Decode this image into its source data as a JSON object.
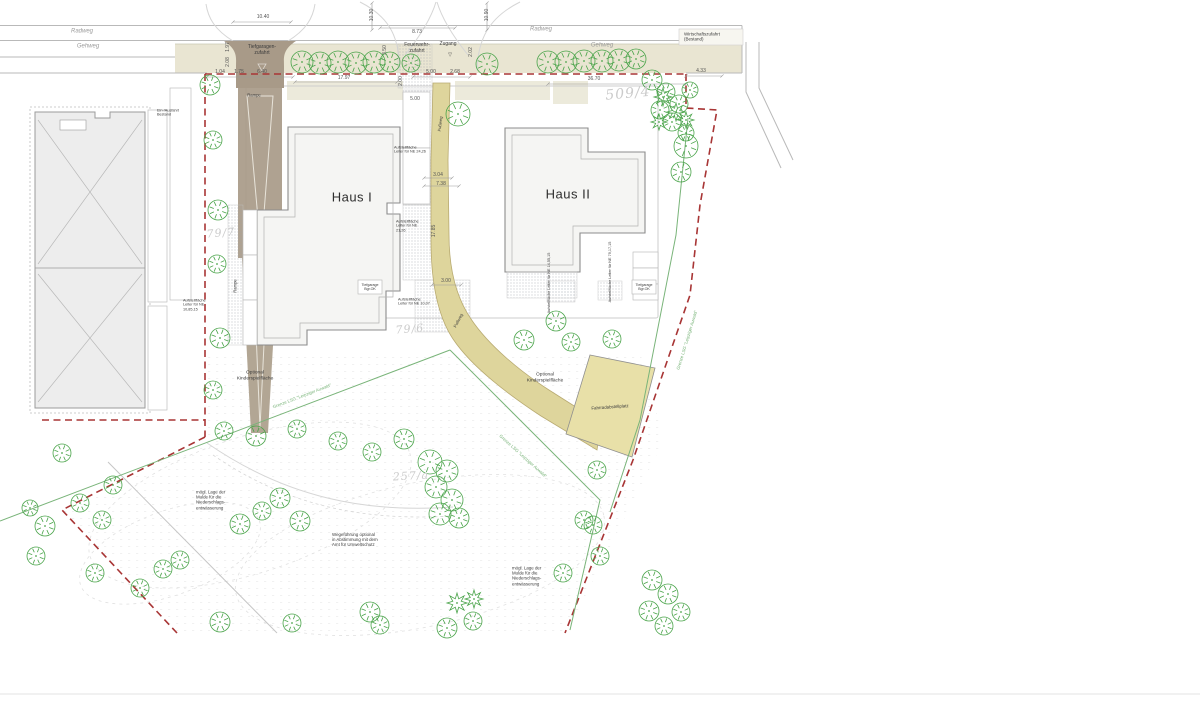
{
  "title": "Lageplan Haus I / Haus II",
  "colors": {
    "boundary": "#a83535",
    "lsg": "#79b479",
    "tree": "#4aa44a",
    "band": "#e9e5d2",
    "ramp": "#a89a88",
    "ramp2": "#b2a694",
    "path": "#ded59c",
    "bike": "#e8e0a8",
    "bld": "#f5f5f3",
    "ex": "#ededed"
  },
  "labels": [
    {
      "t": "Radweg",
      "x": 82,
      "y": 32,
      "s": 6,
      "c": "road",
      "n": "radweg-label-left"
    },
    {
      "t": "Gehweg",
      "x": 88,
      "y": 47,
      "s": 6,
      "c": "road",
      "n": "gehweg-label-left"
    },
    {
      "t": "Radweg",
      "x": 541,
      "y": 30,
      "s": 6,
      "c": "road",
      "n": "radweg-label-right"
    },
    {
      "t": "Gehweg",
      "x": 602,
      "y": 46,
      "s": 6,
      "c": "road",
      "n": "gehweg-label-right"
    },
    {
      "t": "Wirtschaftszufahrt\n(Bestand)",
      "x": 684,
      "y": 37,
      "s": 4.5,
      "a": "l",
      "n": "wirtschaftszufahrt-label"
    },
    {
      "t": "Tiefgaragen-\nzufahrt",
      "x": 262,
      "y": 51,
      "s": 5,
      "n": "tiefgaragenzufahrt-label"
    },
    {
      "t": "Feuerwehr-\nzufahrt",
      "x": 417,
      "y": 49,
      "s": 5,
      "n": "feuerwehrzufahrt-label"
    },
    {
      "t": "Zugang",
      "x": 448,
      "y": 45,
      "s": 5,
      "n": "zugang-label"
    },
    {
      "t": "▽",
      "x": 450,
      "y": 56,
      "s": 5,
      "n": "zugang-arrow"
    },
    {
      "t": "Rampe",
      "x": 254,
      "y": 96,
      "s": 4.2,
      "n": "rampe-label"
    },
    {
      "t": "Rampe",
      "x": 236,
      "y": 286,
      "s": 4.2,
      "r": -90,
      "n": "rampe-label-rotated"
    },
    {
      "t": "Fußweg",
      "x": 441,
      "y": 124,
      "s": 4.2,
      "r": -83,
      "n": "fussweg-label-upper"
    },
    {
      "t": "Fußweg",
      "x": 459,
      "y": 321,
      "s": 4.2,
      "r": -62,
      "n": "fussweg-label-lower"
    },
    {
      "t": "Haus I",
      "x": 352,
      "y": 197,
      "s": 13,
      "c": "haus",
      "n": "haus-1-label"
    },
    {
      "t": "Haus II",
      "x": 568,
      "y": 194,
      "s": 13,
      "c": "haus",
      "n": "haus-2-label"
    },
    {
      "t": "509/4",
      "x": 628,
      "y": 94,
      "s": 14,
      "c": "parcel",
      "r": -5,
      "n": "parcel-509-4"
    },
    {
      "t": "79/7",
      "x": 221,
      "y": 234,
      "s": 11,
      "c": "parcel",
      "r": -5,
      "n": "parcel-79-7"
    },
    {
      "t": "79/6",
      "x": 410,
      "y": 330,
      "s": 11,
      "c": "parcel",
      "r": -5,
      "n": "parcel-79-6"
    },
    {
      "t": "257/a",
      "x": 411,
      "y": 477,
      "s": 11,
      "c": "parcel",
      "r": -3,
      "n": "parcel-257-a"
    },
    {
      "t": "Optional\nKinderspielfläche",
      "x": 255,
      "y": 376,
      "s": 4.8,
      "n": "kinderspielflaeche-label-left"
    },
    {
      "t": "Optional\nKinderspielfläche",
      "x": 545,
      "y": 378,
      "s": 4.8,
      "n": "kinderspielflaeche-label-right"
    },
    {
      "t": "Fahrradabstellplatz",
      "x": 610,
      "y": 407,
      "s": 4.4,
      "r": -4,
      "n": "fahrradabstellplatz-label"
    },
    {
      "t": "mögl. Lage der\nMulde für die\nNiederschlags-\nentwässerung",
      "x": 196,
      "y": 500,
      "s": 4.4,
      "a": "l",
      "n": "mulde-label-left"
    },
    {
      "t": "mögl. Lage der\nMulde für die\nNiederschlags-\nentwässerung",
      "x": 512,
      "y": 576,
      "s": 4.4,
      "a": "l",
      "n": "mulde-label-right"
    },
    {
      "t": "Wegeführung optional\nin Abstimmung mit dem\nAmt für Umweltschutz",
      "x": 332,
      "y": 540,
      "s": 4.4,
      "a": "l",
      "n": "wegefuehrung-label"
    },
    {
      "t": "Grenze LSG \"Leipziger Auwald\"",
      "x": 302,
      "y": 396,
      "s": 4.4,
      "c": "lsg",
      "r": -21,
      "n": "lsg-grenze-label-1"
    },
    {
      "t": "Grenze LSG \"Leipziger Auwald\"",
      "x": 523,
      "y": 456,
      "s": 4.4,
      "c": "lsg",
      "r": 42,
      "n": "lsg-grenze-label-2"
    },
    {
      "t": "Grenze LSG \"Leipziger Auwald\"",
      "x": 687,
      "y": 340,
      "s": 4.4,
      "c": "lsg",
      "r": -73,
      "n": "lsg-grenze-label-3"
    },
    {
      "t": "Aufstellfläche\nLeiter für NE\n10,85,15",
      "x": 183,
      "y": 305,
      "s": 3.8,
      "a": "l",
      "n": "aufstellflaeche-1"
    },
    {
      "t": "Aufstellfläche\nLeiter für NE 24,26",
      "x": 394,
      "y": 150,
      "s": 3.8,
      "a": "l",
      "n": "aufstellflaeche-2"
    },
    {
      "t": "Aufstellfläche\nLeiter für NE\n21,26",
      "x": 396,
      "y": 226,
      "s": 3.8,
      "a": "l",
      "n": "aufstellflaeche-3"
    },
    {
      "t": "Aufstellfläche\nLeiter für NE 10,07",
      "x": 398,
      "y": 302,
      "s": 3.8,
      "a": "l",
      "n": "aufstellflaeche-4"
    },
    {
      "t": "Aufstellfläche Leiter für NE 14,55,15",
      "x": 549,
      "y": 283,
      "s": 3.8,
      "r": -90,
      "n": "aufstellflaeche-5"
    },
    {
      "t": "Aufstellfläche Leiter für NE 79,17,15",
      "x": 610,
      "y": 272,
      "s": 3.8,
      "r": -90,
      "n": "aufstellflaeche-6"
    },
    {
      "t": "Tiefgarage\nBgr.OK",
      "x": 370,
      "y": 287,
      "s": 3.6,
      "n": "tiefgarage-box-label-1"
    },
    {
      "t": "Tiefgarage\nBgr.OK",
      "x": 644,
      "y": 287,
      "s": 3.6,
      "n": "tiefgarage-box-label-2"
    },
    {
      "t": "Ein-/Ausfahrt\nBestand",
      "x": 157,
      "y": 113,
      "s": 3.8,
      "a": "l",
      "n": "bestand-zufahrt-label"
    }
  ],
  "dimensions": [
    {
      "t": "10.40",
      "x": 263,
      "y": 17
    },
    {
      "t": "8.73",
      "x": 417,
      "y": 32
    },
    {
      "t": "36.70",
      "x": 594,
      "y": 79
    },
    {
      "t": "4.33",
      "x": 701,
      "y": 71
    },
    {
      "t": "17.97",
      "x": 344,
      "y": 78
    },
    {
      "t": "1.04",
      "x": 220,
      "y": 72
    },
    {
      "t": "1.75",
      "x": 239,
      "y": 72
    },
    {
      "t": "6.40",
      "x": 262,
      "y": 72
    },
    {
      "t": "5.00",
      "x": 431,
      "y": 72
    },
    {
      "t": "2.68",
      "x": 455,
      "y": 72
    },
    {
      "t": "5.00",
      "x": 415,
      "y": 99
    },
    {
      "t": "3.00",
      "x": 446,
      "y": 281
    },
    {
      "t": "3.04",
      "x": 438,
      "y": 175
    },
    {
      "t": "7.38",
      "x": 441,
      "y": 184
    },
    {
      "t": "10.30",
      "x": 372,
      "y": 15,
      "r": -90
    },
    {
      "t": "10.90",
      "x": 487,
      "y": 15,
      "r": -90
    },
    {
      "t": "3.50",
      "x": 385,
      "y": 50,
      "r": -90
    },
    {
      "t": "2.02",
      "x": 471,
      "y": 52,
      "r": -90
    },
    {
      "t": "1.97",
      "x": 228,
      "y": 47,
      "r": -90
    },
    {
      "t": "2.08",
      "x": 228,
      "y": 62,
      "r": -90
    },
    {
      "t": "2.00",
      "x": 401,
      "y": 81,
      "r": -90
    },
    {
      "t": "17.85",
      "x": 434,
      "y": 231,
      "r": -90
    }
  ],
  "dim_lines": [
    [
      233,
      22,
      291,
      22
    ],
    [
      380,
      28,
      455,
      28
    ],
    [
      548,
      84,
      686,
      84
    ],
    [
      686,
      76,
      722,
      76
    ],
    [
      295,
      82,
      397,
      82
    ],
    [
      207,
      77,
      293,
      77
    ],
    [
      413,
      77,
      470,
      77
    ],
    [
      432,
      285,
      461,
      285
    ],
    [
      424,
      178,
      452,
      178
    ],
    [
      424,
      186,
      459,
      186
    ],
    [
      372,
      3,
      372,
      30
    ],
    [
      487,
      3,
      487,
      30
    ]
  ],
  "trees": [
    [
      302,
      62,
      11
    ],
    [
      320,
      63,
      11
    ],
    [
      338,
      62,
      11
    ],
    [
      356,
      63,
      11
    ],
    [
      374,
      62,
      11
    ],
    [
      390,
      62,
      10
    ],
    [
      411,
      63,
      9
    ],
    [
      487,
      64,
      11
    ],
    [
      548,
      62,
      11
    ],
    [
      566,
      62,
      11
    ],
    [
      584,
      61,
      11
    ],
    [
      602,
      61,
      11
    ],
    [
      619,
      60,
      11
    ],
    [
      636,
      59,
      10
    ],
    [
      652,
      80,
      10
    ],
    [
      666,
      92,
      9
    ],
    [
      679,
      104,
      9
    ],
    [
      660,
      110,
      9
    ],
    [
      672,
      122,
      9
    ],
    [
      686,
      133,
      8
    ],
    [
      690,
      90,
      8
    ],
    [
      663,
      97,
      9,
      1
    ],
    [
      676,
      112,
      9,
      1
    ],
    [
      659,
      122,
      8,
      1
    ],
    [
      686,
      120,
      8,
      1
    ],
    [
      210,
      85,
      10
    ],
    [
      213,
      140,
      9
    ],
    [
      218,
      210,
      10
    ],
    [
      217,
      264,
      9
    ],
    [
      220,
      338,
      10
    ],
    [
      213,
      390,
      9
    ],
    [
      224,
      431,
      9
    ],
    [
      458,
      114,
      12
    ],
    [
      524,
      340,
      10
    ],
    [
      556,
      321,
      10
    ],
    [
      571,
      342,
      9
    ],
    [
      612,
      339,
      9
    ],
    [
      686,
      146,
      12
    ],
    [
      681,
      172,
      10
    ],
    [
      256,
      436,
      10
    ],
    [
      297,
      429,
      9
    ],
    [
      338,
      441,
      9
    ],
    [
      372,
      452,
      9
    ],
    [
      404,
      439,
      10
    ],
    [
      597,
      470,
      9
    ],
    [
      584,
      520,
      9
    ],
    [
      563,
      573,
      9
    ],
    [
      593,
      525,
      9
    ],
    [
      430,
      462,
      12
    ],
    [
      447,
      471,
      11
    ],
    [
      436,
      487,
      11
    ],
    [
      452,
      500,
      11
    ],
    [
      440,
      514,
      11
    ],
    [
      459,
      518,
      10
    ],
    [
      280,
      498,
      10
    ],
    [
      262,
      511,
      9
    ],
    [
      300,
      521,
      10
    ],
    [
      240,
      524,
      10
    ],
    [
      180,
      560,
      9
    ],
    [
      163,
      569,
      9
    ],
    [
      140,
      588,
      9
    ],
    [
      102,
      520,
      9
    ],
    [
      95,
      573,
      9
    ],
    [
      62,
      453,
      9
    ],
    [
      80,
      503,
      9
    ],
    [
      113,
      485,
      9
    ],
    [
      45,
      526,
      10
    ],
    [
      36,
      556,
      9
    ],
    [
      30,
      508,
      8
    ],
    [
      220,
      622,
      10
    ],
    [
      292,
      623,
      9
    ],
    [
      370,
      612,
      10
    ],
    [
      380,
      625,
      9
    ],
    [
      447,
      628,
      10
    ],
    [
      473,
      621,
      9
    ],
    [
      457,
      603,
      10,
      1
    ],
    [
      474,
      599,
      9,
      1
    ],
    [
      652,
      580,
      10
    ],
    [
      668,
      594,
      10
    ],
    [
      649,
      611,
      10
    ],
    [
      664,
      626,
      9
    ],
    [
      681,
      612,
      9
    ],
    [
      600,
      556,
      9
    ]
  ]
}
